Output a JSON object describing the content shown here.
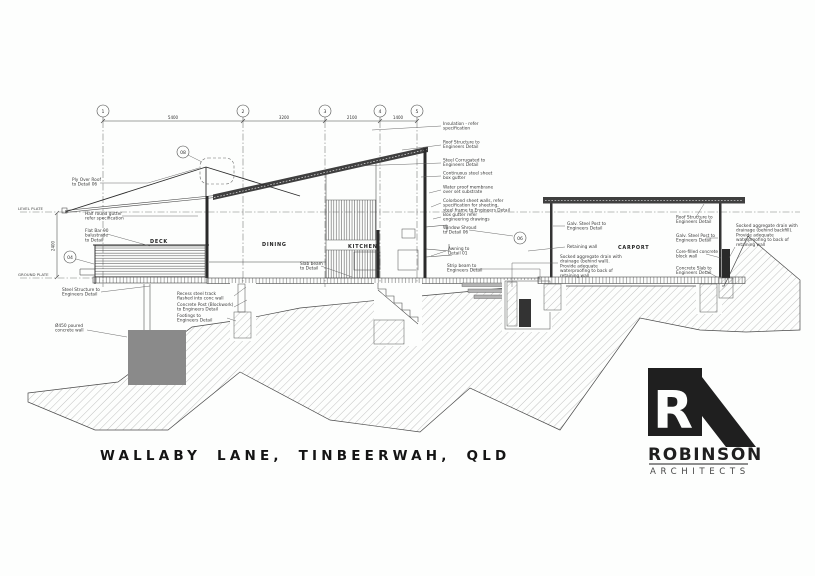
{
  "title_block": {
    "project_title": "WALLABY LANE, TINBEERWAH, QLD"
  },
  "logo": {
    "monogram_letter": "R",
    "name": "ROBINSON",
    "subtitle": "ARCHITECTS"
  },
  "grid": {
    "labels": [
      "1",
      "2",
      "3",
      "4",
      "5"
    ],
    "dimensions": [
      "5400",
      "3200",
      "2100",
      "1400"
    ],
    "vertical_dimension": "2400"
  },
  "levels": {
    "upper": "LEVEL PLATE",
    "lower": "GROUND PLATE"
  },
  "rooms": {
    "deck": "DECK",
    "dining": "DINING",
    "kitchen": "KITCHEN",
    "carport": "CARPORT"
  },
  "detail_markers": {
    "roof_apex": "08",
    "deck_edge": "04",
    "window_shroud": "06"
  },
  "notes_left": [
    {
      "lines": [
        "Ply Over Roof",
        "to Detail 06"
      ]
    },
    {
      "lines": [
        "Half round gutter",
        "refer specification"
      ]
    },
    {
      "lines": [
        "Flat Bar 90",
        "balustrade",
        "to Detail"
      ]
    },
    {
      "lines": [
        "Steel Structure to",
        "Engineers Detail"
      ]
    },
    {
      "lines": [
        "Ø450 poured",
        "concrete wall"
      ]
    }
  ],
  "notes_bottom": [
    {
      "lines": [
        "Recess steel track",
        "flashed into conc wall"
      ]
    },
    {
      "lines": [
        "Concrete Post (Blockwork)",
        "to Engineers Detail"
      ]
    },
    {
      "lines": [
        "Footings to",
        "Engineers Detail"
      ]
    }
  ],
  "notes_mid": [
    {
      "lines": [
        "Slab beam",
        "to Detail"
      ]
    }
  ],
  "notes_right": [
    {
      "lines": [
        "Insulation - refer",
        "specification"
      ]
    },
    {
      "lines": [
        "Roof Structure to",
        "Engineers Detail"
      ]
    },
    {
      "lines": [
        "Steel Corrugated to",
        "Engineers Detail"
      ]
    },
    {
      "lines": [
        "Continuous steel sheet",
        "box gutter"
      ]
    },
    {
      "lines": [
        "Water proof membrane",
        "over set substrate"
      ]
    },
    {
      "lines": [
        "Colorbond sheet walls, refer",
        "specification for sheeting,",
        "steel frame to Engineers Detail"
      ]
    },
    {
      "lines": [
        "Box gutter refer",
        "engineering drawings"
      ]
    },
    {
      "lines": [
        "Window Shroud",
        "to Detail 06"
      ]
    },
    {
      "lines": [
        "Awning to",
        "Detail 01"
      ]
    },
    {
      "lines": [
        "Strip beam to",
        "Engineers Detail"
      ]
    }
  ],
  "notes_carport_left": [
    {
      "lines": [
        "Galv. Steel Post to",
        "Engineers Detail"
      ]
    },
    {
      "lines": [
        "Retaining wall"
      ]
    },
    {
      "lines": [
        "Socked aggregate drain with",
        "drainage (behind wall).",
        "Provide adequate",
        "waterproofing to back of",
        "retaining wall"
      ]
    }
  ],
  "notes_carport_right": [
    {
      "lines": [
        "Roof Structure to",
        "Engineers Detail"
      ]
    },
    {
      "lines": [
        "Galv. Steel Post to",
        "Engineers Detail"
      ]
    },
    {
      "lines": [
        "Core-filled concrete",
        "block wall"
      ]
    },
    {
      "lines": [
        "Concrete Slab to",
        "Engineers Detail"
      ]
    }
  ],
  "notes_far_right": [
    {
      "lines": [
        "Socked aggregate drain with",
        "drainage (behind backfill).",
        "Provide adequate",
        "waterproofing to back of",
        "retaining wall"
      ]
    }
  ]
}
